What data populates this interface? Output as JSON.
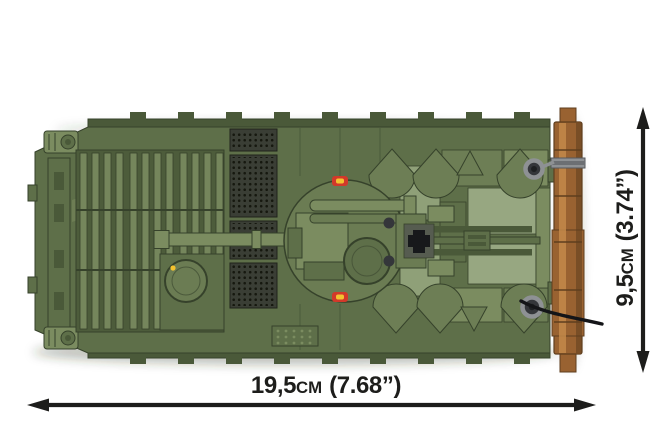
{
  "figure": {
    "subject": "Green military tank building-block model seen from above, with a brown wooden log mounted along the rear edge",
    "style": "product dimension diagram on white background"
  },
  "dimensions": {
    "width": {
      "value": "19,5",
      "unit": "cm",
      "imperial": "(7.68”)"
    },
    "height": {
      "value": "9,5",
      "unit": "cm",
      "imperial": "(3.74”)"
    }
  },
  "colors": {
    "hull": "#5e6f49",
    "hullLight": "#7b8c60",
    "hullDark": "#4a5939",
    "hullDarker": "#36422b",
    "slat": "#75865c",
    "slatBg": "#4d5c3b",
    "grille": "#3a3e35",
    "grilleDot": "#16180f",
    "turret": "#6b7c53",
    "panel": "#8fa078",
    "panelLight": "#97a781",
    "wedge": "#6d7e55",
    "red": "#d2392a",
    "yellow": "#f3c22f",
    "cross": "#17191b",
    "log": "#996231",
    "logLight": "#c3894a",
    "logDark": "#5f3e1e",
    "metal": "#8e9194",
    "metalDark": "#34363a",
    "cable": "#141518",
    "annotation": "#1d1d1b"
  }
}
